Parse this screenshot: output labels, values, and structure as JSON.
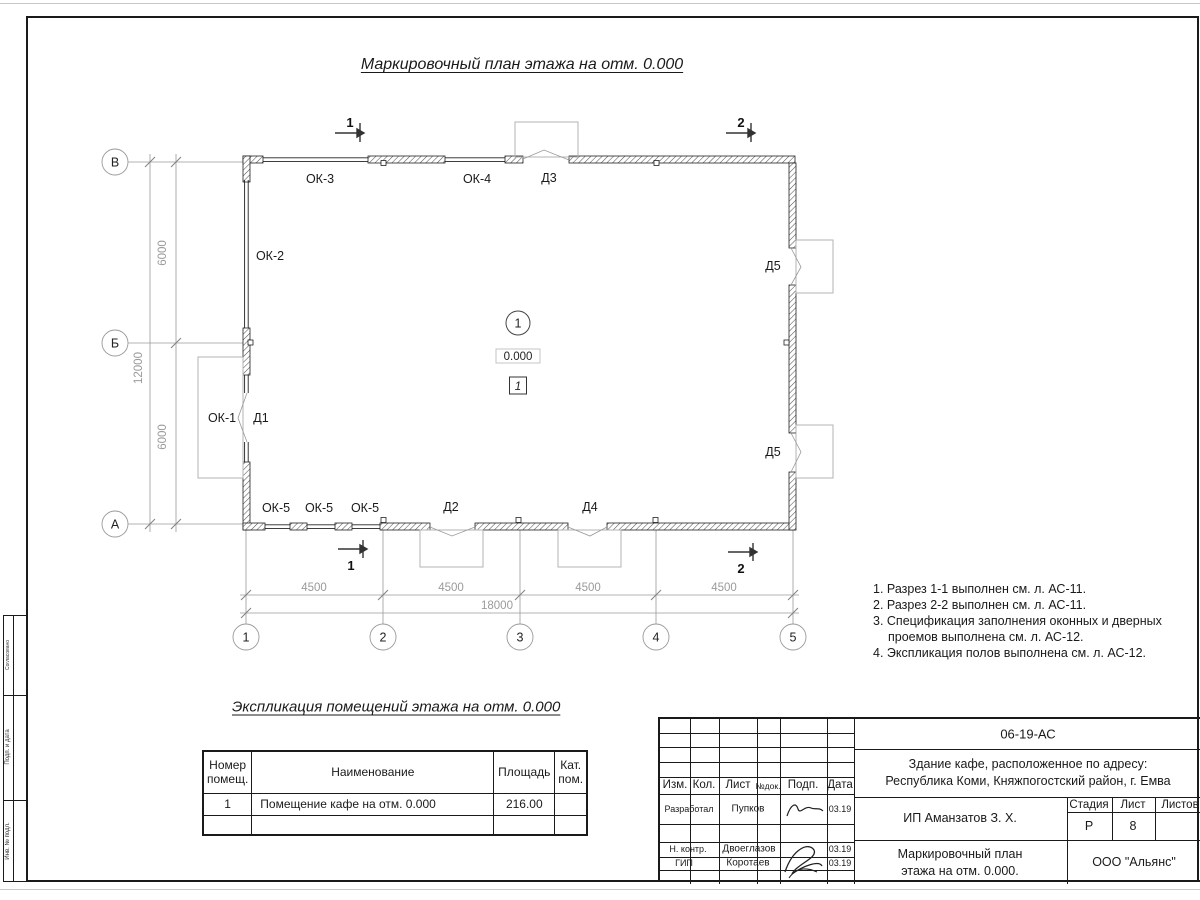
{
  "sheet": {
    "title": "Маркировочный план этажа на отм. 0.000"
  },
  "plan": {
    "grid_rows": [
      "В",
      "Б",
      "А"
    ],
    "grid_cols": [
      "1",
      "2",
      "3",
      "4",
      "5"
    ],
    "dims": {
      "span_6000": "6000",
      "total_left": "12000",
      "span_4500": "4500",
      "total_bottom": "18000"
    },
    "openings": {
      "ok1": "ОК-1",
      "ok2": "ОК-2",
      "ok3": "ОК-3",
      "ok4": "ОК-4",
      "ok5": "ОК-5",
      "d1": "Д1",
      "d2": "Д2",
      "d3": "Д3",
      "d4": "Д4",
      "d5": "Д5"
    },
    "room": {
      "number": "1",
      "elevation": "0.000",
      "floor_type": "1"
    },
    "sections": {
      "s1": "1",
      "s2": "2"
    }
  },
  "notes": [
    "1. Разрез 1-1 выполнен см. л. АС-11.",
    "2. Разрез 2-2 выполнен см. л. АС-11.",
    "3. Спецификация заполнения оконных и дверных проемов выполнена см. л. АС-12.",
    "4. Экспликация полов выполнена см. л. АС-12."
  ],
  "explication": {
    "title": "Экспликация помещений этажа на отм. 0.000",
    "headers": {
      "number": "Номер помещ.",
      "name": "Наименование",
      "area": "Площадь",
      "category": "Кат. пом."
    },
    "rows": [
      {
        "number": "1",
        "name": "Помещение кафе на отм. 0.000",
        "area": "216.00",
        "category": ""
      }
    ]
  },
  "stamp": {
    "doc_code": "06-19-АС",
    "header": {
      "izm": "Изм.",
      "kol": "Кол.",
      "list": "Лист",
      "ndok": "№док.",
      "podp": "Подп.",
      "data": "Дата"
    },
    "rows": [
      {
        "role": "Разработал",
        "name": "Пупков",
        "date": "03.19"
      },
      {
        "role": "Н. контр.",
        "name": "Двоеглазов",
        "date": "03.19"
      },
      {
        "role": "ГИП",
        "name": "Коротаев",
        "date": "03.19"
      }
    ],
    "object_line1": "Здание кафе, расположенное по адресу:",
    "object_line2": "Республика Коми, Княжпогостский район, г. Емва",
    "client": "ИП Аманзатов З. Х.",
    "stage_label": "Стадия",
    "sheet_label": "Лист",
    "sheets_label": "Листов",
    "stage": "Р",
    "sheet_no": "8",
    "sheets_total": "",
    "drawing_name_line1": "Маркировочный план",
    "drawing_name_line2": "этажа на отм. 0.000.",
    "company": "ООО \"Альянс\""
  },
  "frame": {
    "side_blocks": [
      "Согласовано",
      "Подп. и дата",
      "Инв. № подл."
    ]
  }
}
